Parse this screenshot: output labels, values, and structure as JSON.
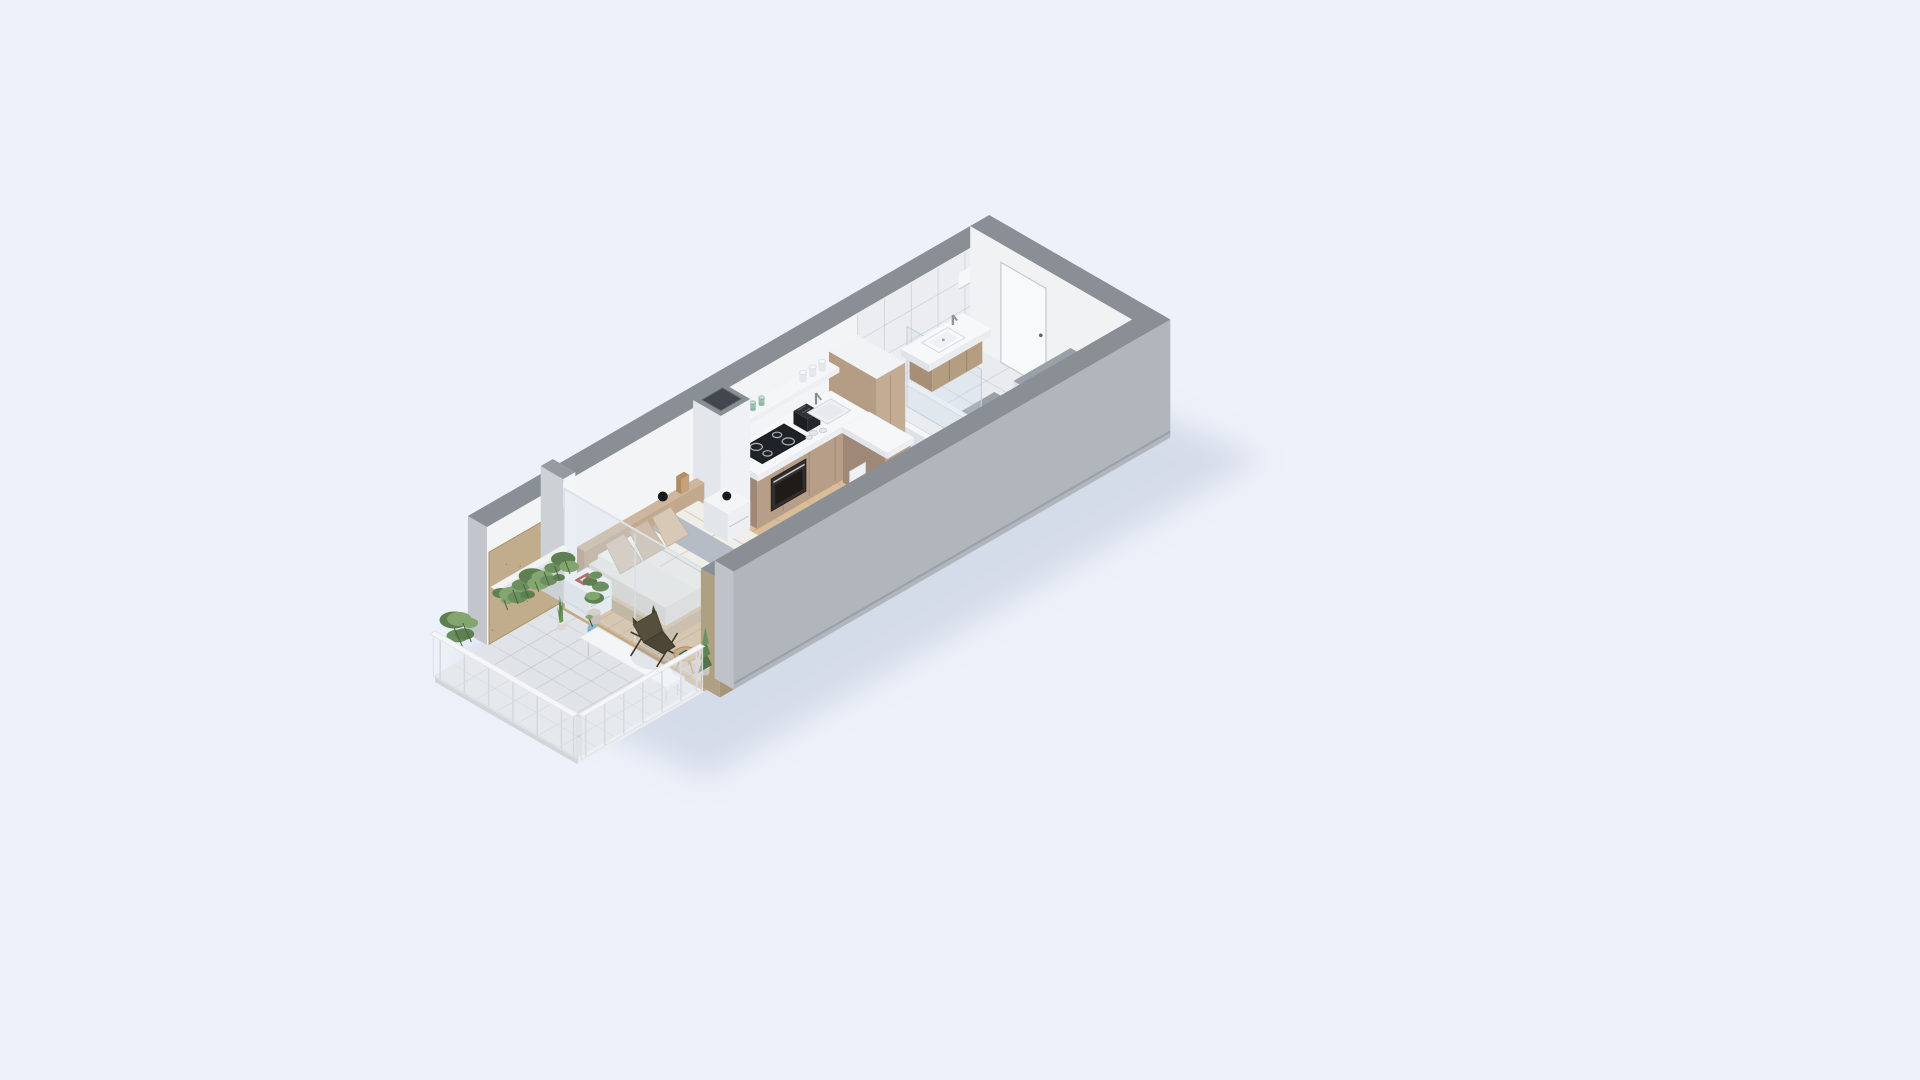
{
  "meta": {
    "title": "Isometric 3D floor plan render of a studio apartment with balcony",
    "render_type": "axonometric cutaway"
  },
  "canvas": {
    "width": 1920,
    "height": 1080,
    "background": "#edf1fa"
  },
  "palette": {
    "background": "#edf1fa",
    "shadow": "#c3cbdc",
    "wall_top": "#8a8f96",
    "wall_interior": "#f3f4f6",
    "wall_exterior": "#b1b6bd",
    "wall_edge": "#c2c6cc",
    "wood_floor": "#d9bd98",
    "wood_floor_line": "#9b7a52",
    "balcony_floor": "#e0e3e7",
    "marble": "#e9ebef",
    "marble_line": "#aab2be",
    "plywood": "#c1ad8c",
    "cabinet_front": "#b79e88",
    "cabinet_side": "#a08876",
    "cabinet_tall": "#c3ab94",
    "counter_white": "#f6f7f9",
    "appliance_dark": "#1f2226",
    "bed_wood": "#c2a98d",
    "linen": "#eceae5",
    "throw_gray": "#b6bcc5",
    "pillow_beige": "#d8c8b6",
    "sofa_blush": "#e7d5d1",
    "white_furniture": "#f2f3f5",
    "plant_green": "#5e7f52",
    "plant_green_light": "#83a56e",
    "plant_green_dark": "#46663e",
    "leather_chair": "#564f3e",
    "table_wood": "#c9a97e",
    "accent_red_book": "#a8402f",
    "accent_teal_book": "#2e6b66",
    "accent_blue_pot": "#6fa6c9",
    "glass_tint": "rgba(205,222,235,0.30)"
  },
  "rooms": [
    {
      "id": "balcony",
      "label": "balcony"
    },
    {
      "id": "bedroom",
      "label": "sleeping-area"
    },
    {
      "id": "kitchen",
      "label": "kitchen"
    },
    {
      "id": "dining",
      "label": "dining-area"
    },
    {
      "id": "living",
      "label": "living-area"
    },
    {
      "id": "bathroom",
      "label": "bathroom"
    },
    {
      "id": "hallway",
      "label": "entry-hallway"
    }
  ],
  "furniture": [
    "balcony-floor",
    "wood-floor",
    "marble-floor",
    "back-wall",
    "window-pier",
    "end-wall",
    "entry-door",
    "bathroom-partitions",
    "bathtub",
    "shower-glass",
    "bathroom-vanity",
    "tall-cabinet",
    "kitchen-cabinets",
    "kitchen-shelf",
    "ventilation-shaft",
    "bed",
    "nightstand-left",
    "nightstand-right",
    "dining-chairs",
    "dining-table",
    "fruit-bowl",
    "sofa",
    "hallway-bench",
    "window-glass",
    "front-wall",
    "balcony-plants",
    "balcony-bench",
    "butterfly-chair",
    "balcony-side-table",
    "conifer-plant",
    "balcony-railings"
  ]
}
